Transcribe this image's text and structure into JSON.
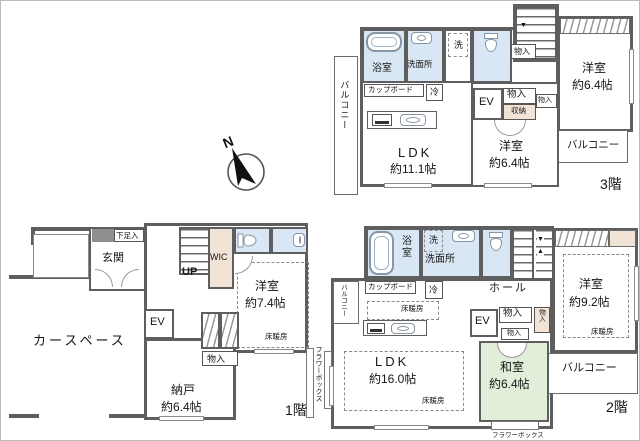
{
  "colors": {
    "wall": "#5e5e5e",
    "wet_room": "#d8e7f3",
    "closet": "#f2e3d7",
    "tatami": "#e1eeda"
  },
  "compass": {
    "n": "N"
  },
  "floor3": {
    "floor_label": "3階",
    "balcony_left": "バルコニー",
    "bath": "浴室",
    "washroom": "洗面所",
    "washer": "洗",
    "monoire_top": "物入",
    "cupboard": "カップボード",
    "fridge": "冷",
    "ldk": "LDK",
    "ldk_size": "約11.1帖",
    "ev": "EV",
    "monoire_a": "物入",
    "monoire_b": "物入",
    "shuno": "収納",
    "room_center": "洋室",
    "room_center_size": "約6.4帖",
    "room_right": "洋室",
    "room_right_size": "約6.4帖",
    "balcony_right": "バルコニー",
    "stair_arrow": "▼"
  },
  "floor1": {
    "floor_label": "1階",
    "shoe": "下足入",
    "entrance": "玄関",
    "up": "UP",
    "wic": "WIC",
    "room": "洋室",
    "room_size": "約7.4帖",
    "heating": "床暖房",
    "ev": "EV",
    "carspace": "カースペース",
    "monoire": "物入",
    "nando": "納戸",
    "nando_size": "約6.4帖",
    "flowerbox": "フラワーボックス"
  },
  "floor2": {
    "floor_label": "2階",
    "bath": "浴室",
    "washer": "洗",
    "washroom": "洗面所",
    "hall": "ホール",
    "cupboard": "カップボード",
    "fridge": "冷",
    "balcony_left": "バルコニー",
    "heating_kitchen": "床暖房",
    "ldk": "LDK",
    "ldk_size": "約16.0帖",
    "heating_ldk": "床暖房",
    "ev": "EV",
    "monoire_a": "物入",
    "monoire_b": "物入",
    "monoire_c": "物入",
    "washitsu": "和室",
    "washitsu_size": "約6.4帖",
    "room": "洋室",
    "room_size": "約9.2帖",
    "heating_room": "床暖房",
    "balcony_right": "バルコニー",
    "flowerbox": "フラワーボックス",
    "stair_arrow_down": "▼",
    "stair_arrow_up": "▲"
  }
}
